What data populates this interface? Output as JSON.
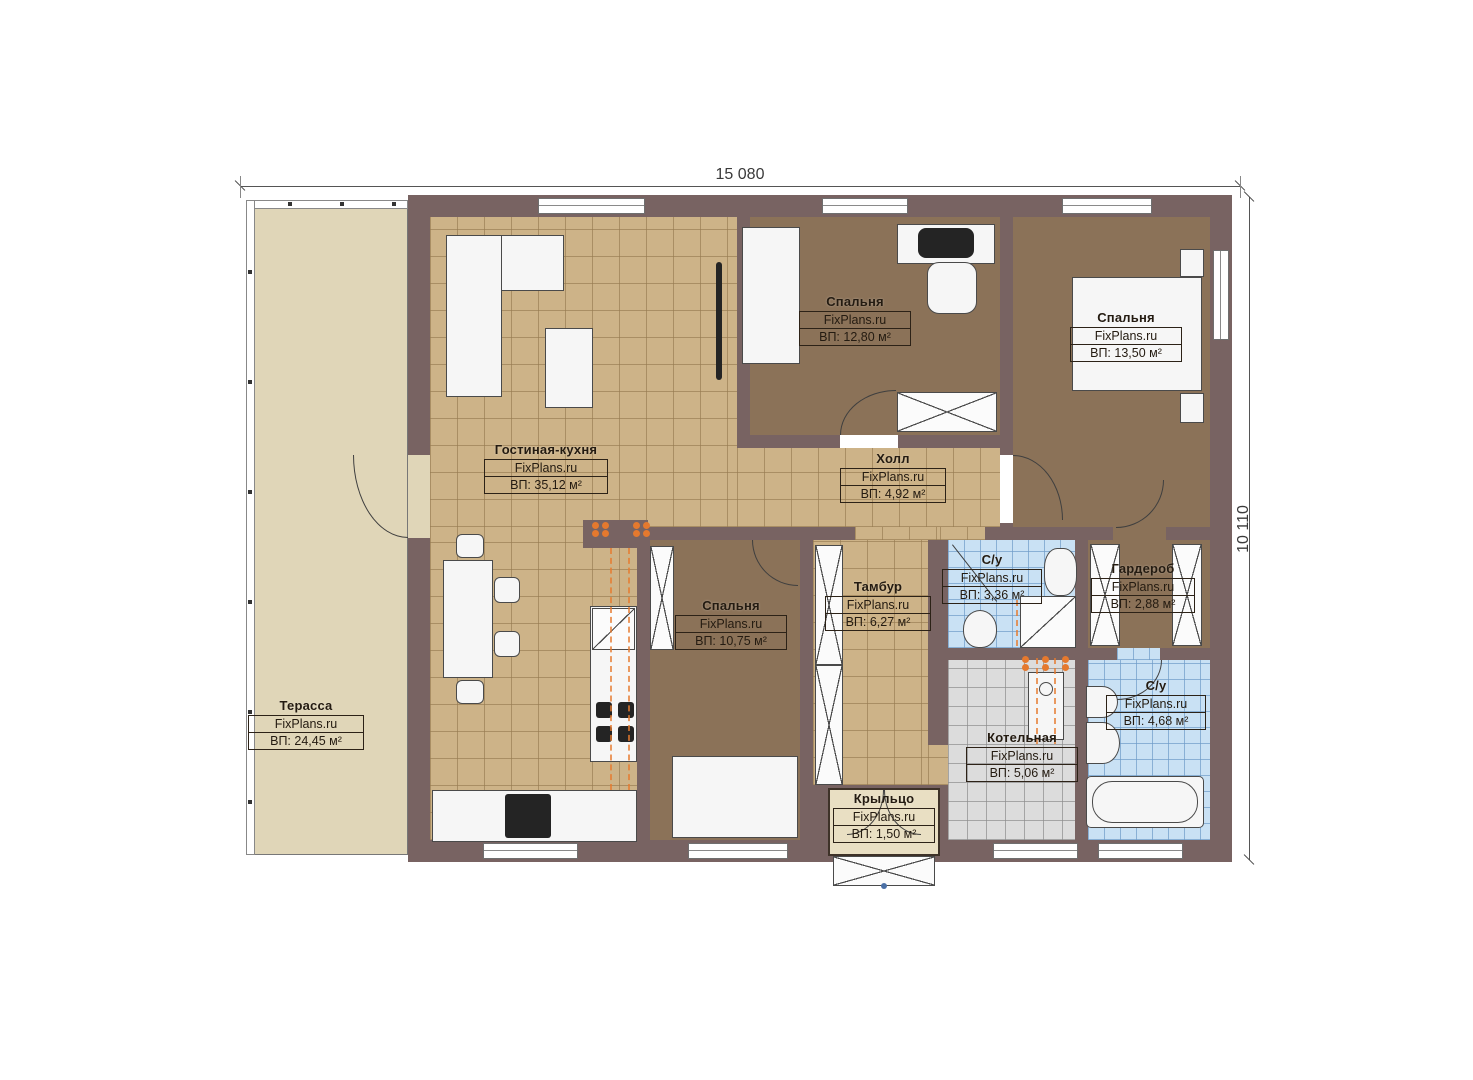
{
  "plan_title": "FixPlans floor plan",
  "dimensions": {
    "width_label": "15 080",
    "height_label": "10 110"
  },
  "rooms": [
    {
      "id": "terrace",
      "name": "Терасса",
      "watermark": "FixPlans.ru",
      "area": "ВП: 24,45 м²"
    },
    {
      "id": "living-kitchen",
      "name": "Гостиная-кухня",
      "watermark": "FixPlans.ru",
      "area": "ВП: 35,12 м²"
    },
    {
      "id": "bedroom-1",
      "name": "Спальня",
      "watermark": "FixPlans.ru",
      "area": "ВП: 12,80 м²"
    },
    {
      "id": "bedroom-2",
      "name": "Спальня",
      "watermark": "FixPlans.ru",
      "area": "ВП: 13,50 м²"
    },
    {
      "id": "hall",
      "name": "Холл",
      "watermark": "FixPlans.ru",
      "area": "ВП: 4,92 м²"
    },
    {
      "id": "bedroom-3",
      "name": "Спальня",
      "watermark": "FixPlans.ru",
      "area": "ВП: 10,75 м²"
    },
    {
      "id": "tambour",
      "name": "Тамбур",
      "watermark": "FixPlans.ru",
      "area": "ВП: 6,27 м²"
    },
    {
      "id": "bathroom-1",
      "name": "С/у",
      "watermark": "FixPlans.ru",
      "area": "ВП: 3,36 м²"
    },
    {
      "id": "wardrobe",
      "name": "Гардероб",
      "watermark": "FixPlans.ru",
      "area": "ВП: 2,88 м²"
    },
    {
      "id": "boiler-room",
      "name": "Котельная",
      "watermark": "FixPlans.ru",
      "area": "ВП: 5,06 м²"
    },
    {
      "id": "bathroom-2",
      "name": "С/у",
      "watermark": "FixPlans.ru",
      "area": "ВП: 4,68 м²"
    },
    {
      "id": "porch",
      "name": "Крыльцо",
      "watermark": "FixPlans.ru",
      "area": "ВП: 1,50 м²"
    }
  ],
  "colors": {
    "wall": "#786362",
    "tan": "#cdb388",
    "brown": "#8b7258",
    "blue": "#c9e1f4",
    "gray": "#dcdcdc",
    "terrace": "#e0d6b8",
    "porch": "#e9dfc3",
    "orange": "#e5792e",
    "ink": "#241b11"
  }
}
